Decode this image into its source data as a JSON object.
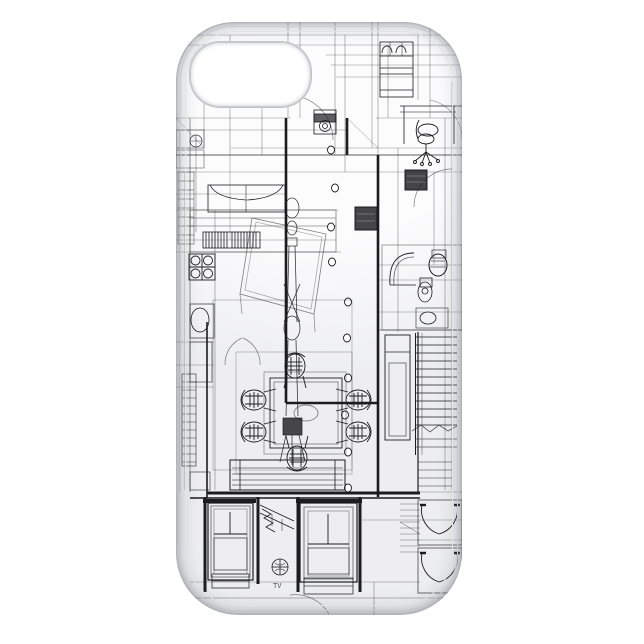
{
  "scene": {
    "description": "product photo of a slim white phone case printed with a black architectural CAD wireframe floor plan",
    "background_label": "plain white backdrop"
  },
  "case": {
    "orientation": "back facing viewer, camera cutout top-left",
    "cutout_label": "camera cutout"
  },
  "artwork": {
    "title_label": "architecture blueprint wireframe print",
    "tv_mark": "TV",
    "elements": [
      "structural-grid-lines",
      "thick-plan-walls",
      "double-bed",
      "kitchen-counter",
      "stove-burners",
      "kitchen-sink",
      "appliance-hatch-band",
      "washing-machine",
      "entry-corridor",
      "wardrobe-cabinet",
      "office-desk",
      "office-swivel-chair",
      "dark-cabinet-blocks",
      "perspective-table",
      "equipment-wireframe",
      "ceiling-light-dots",
      "dining-table",
      "dining-chairs",
      "sofa-bench",
      "ladder-shelves",
      "bathroom-armchair",
      "toilet",
      "wash-basin",
      "staircase-treads",
      "tall-panel",
      "window-elevation-left",
      "window-elevation-right",
      "interior-stair-detail",
      "circle-cross-symbol",
      "double-swing-doors",
      "door-swing-arcs"
    ]
  },
  "colors": {
    "background": "#ffffff",
    "case_surface": "#fcfcfd",
    "case_edge": "#c7c8cc",
    "line": "#1c1c1e"
  }
}
